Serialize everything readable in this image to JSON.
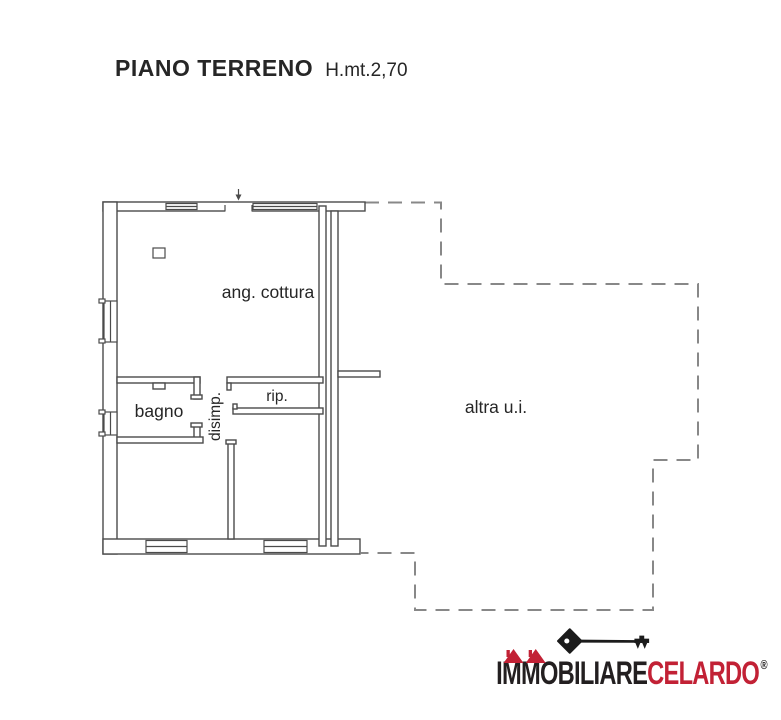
{
  "header": {
    "title": "PIANO TERRENO",
    "subtitle": "H.mt.2,70"
  },
  "floorplan": {
    "rooms": [
      {
        "id": "ang-cottura",
        "label": "ang. cottura"
      },
      {
        "id": "bagno",
        "label": "bagno"
      },
      {
        "id": "disimp",
        "label": "disimp."
      },
      {
        "id": "rip",
        "label": "rip."
      },
      {
        "id": "altra-ui",
        "label": "altra u.i."
      }
    ]
  },
  "logo": {
    "brand_black": "IMMOBILIARE",
    "brand_red": "CELARDO",
    "registered": "®"
  },
  "colors": {
    "line": "#4b4b4b",
    "dash": "#888888",
    "ink": "#262626",
    "brand-red": "#c22135",
    "brand-black": "#231f20"
  }
}
